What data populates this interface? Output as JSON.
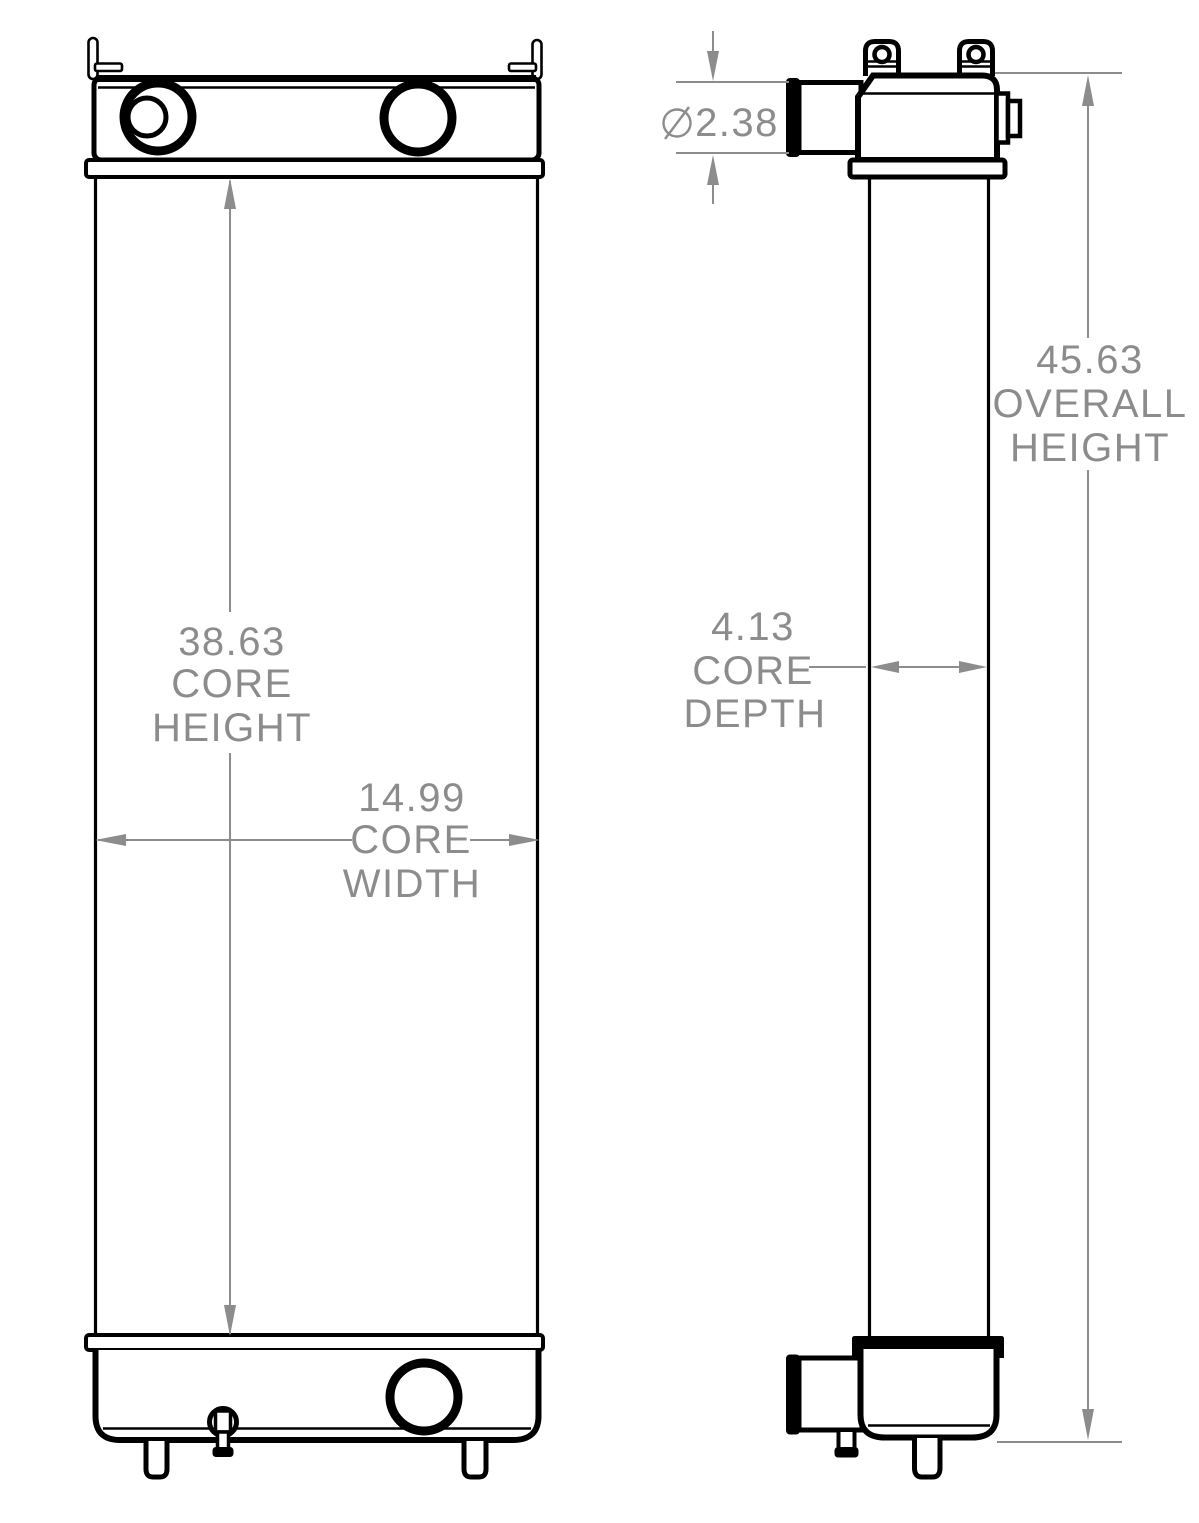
{
  "drawing": {
    "type": "technical-drawing",
    "subject": "radiator two-view dimension drawing",
    "colors": {
      "background": "#ffffff",
      "part_lines": "#000000",
      "dimension_lines": "#8c8c8c",
      "dimension_text": "#8c8c8c"
    },
    "views": {
      "front_view": {
        "parts": [
          "mounting-bracket",
          "top-tank",
          "inlet-port",
          "filler-port",
          "top-header",
          "core",
          "bottom-header",
          "bottom-tank",
          "outlet-port",
          "drain-petcock",
          "mounting-foot"
        ]
      },
      "side_view": {
        "parts": [
          "lifting-hook",
          "top-tank",
          "inlet-pipe",
          "side-fitting",
          "top-header",
          "core",
          "bottom-header",
          "bottom-tank",
          "outlet-pipe",
          "drain-petcock",
          "mounting-foot"
        ]
      }
    },
    "dimensions": {
      "core_height": {
        "value": "38.63",
        "lines": [
          "38.63",
          "CORE",
          "HEIGHT"
        ]
      },
      "core_width": {
        "value": "14.99",
        "lines": [
          "14.99",
          "CORE",
          "WIDTH"
        ]
      },
      "core_depth": {
        "value": "4.13",
        "lines": [
          "4.13",
          "CORE",
          "DEPTH"
        ]
      },
      "overall_height": {
        "value": "45.63",
        "lines": [
          "45.63",
          "OVERALL",
          "HEIGHT"
        ]
      },
      "pipe_diameter": {
        "symbol": "⌀",
        "value": "2.38",
        "label": "⌀ 2.38"
      }
    }
  }
}
